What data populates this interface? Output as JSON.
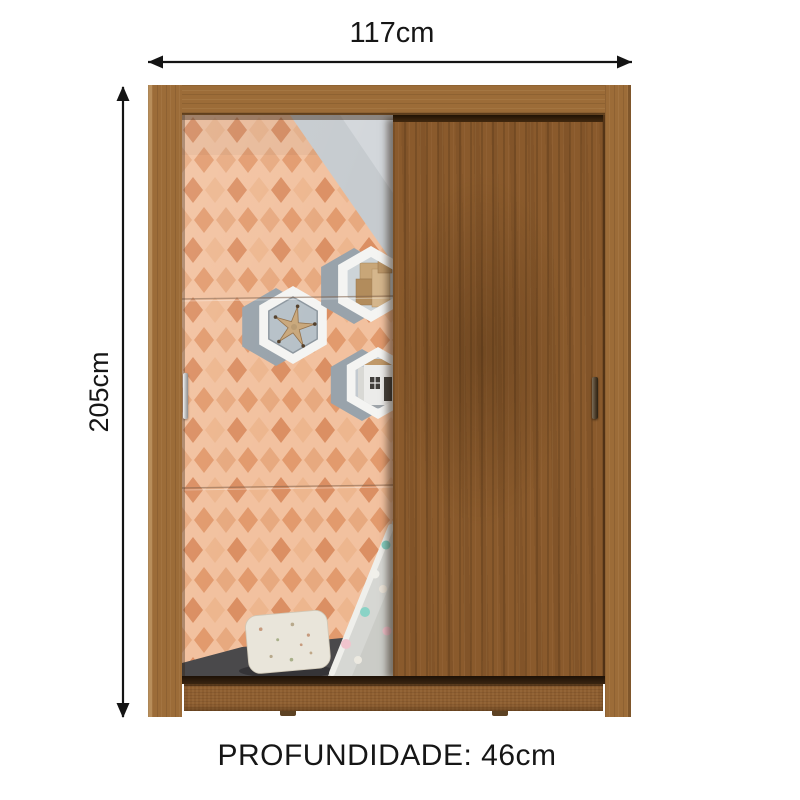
{
  "labels": {
    "width": "117cm",
    "height": "205cm",
    "depth": "PROFUNDIDADE: 46cm"
  },
  "icons": {
    "width_arrow": "double-headed-horizontal-arrow",
    "height_arrow": "double-headed-vertical-arrow"
  },
  "colors": {
    "dimension": "#141414",
    "wood_frame": "#9c6c38",
    "wood_door": "#8a5a2c",
    "wood_base": "#8d5e30",
    "wallpaper_bg": "#f2c19f",
    "diamond_dark": "#db8f63",
    "diamond_mid": "#e29a6d",
    "diamond_light": "#edb68e",
    "diamond_pale": "#e7a97f",
    "wall_gray": "#c6cbcf",
    "wall_gray_light": "#d3d7db",
    "floor_gray": "#4a494b",
    "hex_white": "#f4f4f2",
    "hex_gray": "#99a3ab",
    "hex_interior": "#b7c1c8",
    "teepee": "#d6d7d3",
    "pillow": "#e9e5da",
    "starfish": "#c9a87c"
  },
  "scene": {
    "product": "wardrobe with two sliding doors",
    "left_door": "mirror door reflecting kids room",
    "right_door": "wood sliding door",
    "reflection_items": [
      "peach harlequin diamond wallpaper",
      "hexagon shelf with starfish",
      "hexagon shelf with wooden blocks",
      "hexagon shelf with toy house",
      "floral pillow",
      "teepee tent with pompoms",
      "dark gray floor"
    ]
  }
}
